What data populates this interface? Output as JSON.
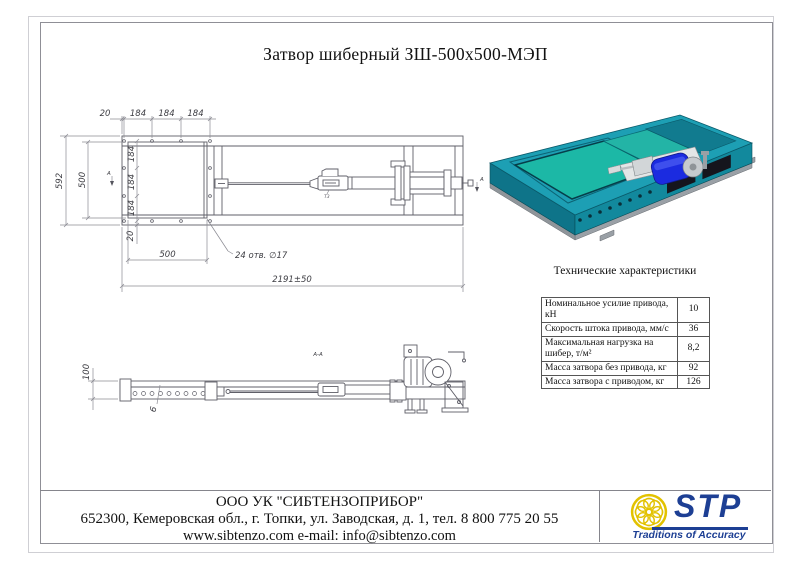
{
  "page": {
    "title": "Затвор шиберный ЗШ-500х500-МЭП"
  },
  "top_view": {
    "dims_top": [
      "20",
      "184",
      "184",
      "184"
    ],
    "dims_side": [
      "184",
      "184",
      "184"
    ],
    "dim_height_outer": "592",
    "dim_height_inner": "500",
    "dim_bottom_edge": "20",
    "dim_width_inner": "500",
    "holes_note": "24 отв. ∅17",
    "dim_overall": "2191±50",
    "section_label": "А",
    "weld_label": "Т3"
  },
  "side_view": {
    "title": "А-А",
    "dim_height": "100",
    "dim_thickness": "6"
  },
  "specs": {
    "title": "Технические характеристики",
    "rows": [
      {
        "label": "Номинальное усилие привода, кН",
        "value": "10"
      },
      {
        "label": "Скорость штока привода, мм/с",
        "value": "36"
      },
      {
        "label": "Максимальная нагрузка на шибер, т/м²",
        "value": "8,2"
      },
      {
        "label": "Масса затвора без привода, кг",
        "value": "92"
      },
      {
        "label": "Масса затвора с приводом, кг",
        "value": "126"
      }
    ]
  },
  "footer": {
    "company": "ООО УК \"СИБТЕНЗОПРИБОР\"",
    "address": "652300, Кемеровская обл., г. Топки, ул. Заводская, д. 1, тел. 8 800 775 20 55",
    "contacts": "www.sibtenzo.com e-mail: info@sibtenzo.com"
  },
  "logo": {
    "abbr": "STP",
    "tagline": "Traditions of Accuracy",
    "colors": {
      "knot_yellow": "#e2c200",
      "blue": "#1d3f94"
    }
  },
  "render_colors": {
    "body_teal": "#1d9fb4",
    "body_teal_dark": "#0e7489",
    "opening_green": "#1cb8a6",
    "tray_teal": "#117b8f",
    "panel_dark": "#15151d",
    "rail_gray": "#9aa0a6",
    "motor_blue": "#1b2be0",
    "metal_light": "#d2d6d8"
  }
}
